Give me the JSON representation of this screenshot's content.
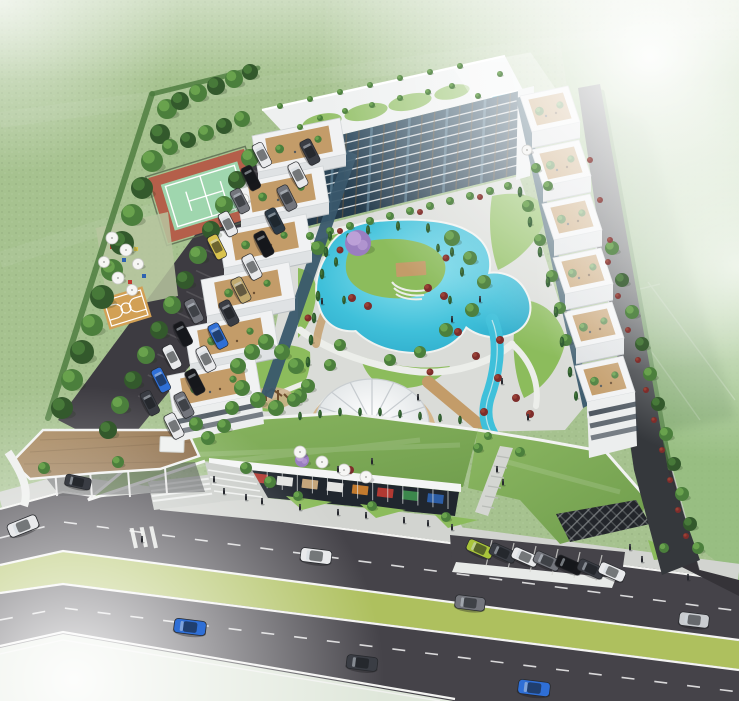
{
  "scene": {
    "type": "aerial-architectural-render",
    "subject": "U-shaped residential complex with landscaped courtyard pool, round pavilion, stepped terrace wings, green-roof retail base, entrance canopy, tennis and basketball courts, parking areas and a boulevard with median"
  },
  "palette": {
    "c_grass_base": "#a6c28f",
    "c_grass_light": "#c6d8b2",
    "c_grass_field": "#93bc7d",
    "c_grass_court": "#8cbc5c",
    "c_grass_roof": "#7fae57",
    "c_median": "#aec05e",
    "c_tree_dark": "#33592c",
    "c_tree_mid": "#4b7f3c",
    "c_tree_light": "#6fa850",
    "c_cypress": "#2d5a2e",
    "c_bush_red": "#7e2d2b",
    "c_bush_red2": "#9c4436",
    "c_tree_purple": "#9a7ec0",
    "c_tree_purple_l": "#c0a4d9",
    "c_water": "#3fc0da",
    "c_water_deep": "#27a3c4",
    "c_water_light": "#90e2ef",
    "c_asphalt": "#454349",
    "c_asphalt_dark": "#353338",
    "c_lot": "#3d3b41",
    "c_white": "#f1f2f3",
    "c_white_dim": "#dfe2e4",
    "c_face_shadow": "#c7ccd0",
    "c_glass": "#223747",
    "c_glass_mid": "#39576b",
    "c_glass_light": "#7fa8bf",
    "c_mullion": "#7c5f3b",
    "c_deck": "#c39c69",
    "c_deck_light": "#d4b183",
    "c_wood_roof": "#9c7b52",
    "c_sidewalk": "#d2d4d0",
    "c_line_white": "#f4f4f2",
    "c_tennis_green": "#9fd6ae",
    "c_tennis_red": "#b45f4a",
    "c_bball": "#d2a055",
    "c_store_dark": "#20262e",
    "c_sign_blue": "#2e62b0",
    "c_sign_red": "#bf3b33",
    "c_sign_orange": "#d2822f",
    "c_sign_green": "#3f8f4f",
    "c_lattice": "#23262b",
    "car_white": "#e9eaec",
    "car_black": "#17181c",
    "car_gray": "#73757c",
    "car_silver": "#c9ccd0",
    "car_blue": "#2f6fd6",
    "car_navy": "#2c3a46",
    "car_lime": "#a9c43b",
    "car_tan": "#c0a96e",
    "car_charcoal": "#3a3d44",
    "car_taxi": "#d9c24c"
  },
  "buildings": {
    "left_wing": {
      "n": 6,
      "ox": 252,
      "oy": 136,
      "sx": -17,
      "sy": 48,
      "bx": 88,
      "by": -18,
      "cx": 6,
      "cy": 36,
      "face": 12
    },
    "right_wing": {
      "n": 6,
      "ox": 520,
      "oy": 96,
      "sx": 11,
      "sy": 54,
      "bx": 48,
      "by": -10,
      "cx": 12,
      "cy": 36,
      "face": 16
    },
    "main_facade": {
      "floors": 9,
      "mullions": 18,
      "tl": [
        296,
        146
      ],
      "tr": [
        523,
        90
      ],
      "bl": [
        292,
        230
      ],
      "br": [
        519,
        174
      ]
    },
    "pavilion": {
      "cx": 372,
      "cy": 424,
      "rx": 57,
      "ry": 45,
      "ribs": 16
    },
    "storefront": {
      "p1": [
        222,
        474
      ],
      "p2": [
        448,
        500
      ],
      "mullions": 15
    }
  },
  "signs": [
    "c_sign_blue",
    "c_sign_red",
    "c_line_white",
    "c_deck_light",
    "c_line_white",
    "c_sign_orange",
    "c_sign_red",
    "c_sign_green",
    "c_sign_blue"
  ],
  "instances": {
    "trees": [
      [
        62,
        408,
        11,
        0
      ],
      [
        72,
        380,
        11,
        1
      ],
      [
        82,
        352,
        12,
        0
      ],
      [
        92,
        325,
        11,
        1
      ],
      [
        102,
        297,
        12,
        0
      ],
      [
        112,
        270,
        11,
        1
      ],
      [
        122,
        243,
        12,
        0
      ],
      [
        132,
        215,
        11,
        1
      ],
      [
        142,
        188,
        11,
        0
      ],
      [
        152,
        161,
        11,
        1
      ],
      [
        160,
        134,
        10,
        0
      ],
      [
        167,
        109,
        10,
        1
      ],
      [
        180,
        101,
        9,
        0
      ],
      [
        198,
        93,
        9,
        1
      ],
      [
        216,
        86,
        9,
        0
      ],
      [
        234,
        79,
        9,
        1
      ],
      [
        250,
        72,
        8,
        0
      ],
      [
        170,
        147,
        8,
        1
      ],
      [
        188,
        140,
        8,
        0
      ],
      [
        206,
        133,
        8,
        1
      ],
      [
        224,
        126,
        8,
        0
      ],
      [
        242,
        119,
        8,
        1
      ],
      [
        108,
        430,
        9,
        0
      ],
      [
        120,
        405,
        9,
        1
      ],
      [
        133,
        380,
        9,
        0
      ],
      [
        146,
        355,
        9,
        1
      ],
      [
        159,
        330,
        9,
        0
      ],
      [
        172,
        305,
        9,
        1
      ],
      [
        185,
        280,
        9,
        0
      ],
      [
        198,
        255,
        9,
        1
      ],
      [
        211,
        230,
        9,
        0
      ],
      [
        224,
        205,
        9,
        1
      ],
      [
        237,
        180,
        9,
        0
      ],
      [
        250,
        158,
        9,
        1
      ],
      [
        612,
        248,
        7,
        1
      ],
      [
        622,
        280,
        7,
        0
      ],
      [
        632,
        312,
        7,
        1
      ],
      [
        642,
        344,
        7,
        0
      ],
      [
        650,
        374,
        7,
        1
      ],
      [
        658,
        404,
        7,
        0
      ],
      [
        666,
        434,
        7,
        1
      ],
      [
        674,
        464,
        7,
        0
      ],
      [
        682,
        494,
        7,
        1
      ],
      [
        690,
        524,
        7,
        0
      ],
      [
        698,
        548,
        6,
        1
      ],
      [
        318,
        248,
        7,
        2
      ],
      [
        452,
        238,
        8,
        2
      ],
      [
        470,
        258,
        7,
        1
      ],
      [
        484,
        282,
        7,
        2
      ],
      [
        472,
        310,
        7,
        1
      ],
      [
        446,
        330,
        7,
        2
      ],
      [
        420,
        352,
        6,
        1
      ],
      [
        390,
        360,
        6,
        2
      ],
      [
        340,
        345,
        6,
        1
      ],
      [
        330,
        365,
        6,
        2
      ],
      [
        300,
        396,
        7,
        1
      ],
      [
        528,
        206,
        6,
        2
      ],
      [
        540,
        240,
        6,
        1
      ],
      [
        552,
        276,
        6,
        2
      ],
      [
        560,
        308,
        6,
        1
      ],
      [
        566,
        340,
        6,
        2
      ],
      [
        536,
        168,
        5,
        1
      ],
      [
        548,
        186,
        5,
        2
      ],
      [
        238,
        366,
        8,
        1
      ],
      [
        252,
        352,
        8,
        2
      ],
      [
        266,
        342,
        8,
        1
      ],
      [
        282,
        352,
        8,
        2
      ],
      [
        296,
        366,
        8,
        1
      ],
      [
        242,
        388,
        8,
        2
      ],
      [
        258,
        400,
        8,
        1
      ],
      [
        276,
        408,
        8,
        2
      ],
      [
        294,
        400,
        7,
        1
      ],
      [
        308,
        386,
        7,
        2
      ],
      [
        232,
        408,
        7,
        1
      ],
      [
        224,
        426,
        7,
        2
      ],
      [
        196,
        424,
        7,
        1
      ],
      [
        208,
        438,
        7,
        2
      ],
      [
        310,
        236,
        4,
        1
      ],
      [
        330,
        231,
        4,
        2
      ],
      [
        350,
        226,
        4,
        1
      ],
      [
        370,
        221,
        4,
        2
      ],
      [
        390,
        216,
        4,
        1
      ],
      [
        410,
        211,
        4,
        2
      ],
      [
        430,
        206,
        4,
        1
      ],
      [
        450,
        201,
        4,
        2
      ],
      [
        470,
        196,
        4,
        1
      ],
      [
        490,
        191,
        4,
        2
      ],
      [
        508,
        186,
        4,
        1
      ],
      [
        320,
        118,
        3,
        1
      ],
      [
        345,
        111,
        3,
        2
      ],
      [
        372,
        105,
        3,
        1
      ],
      [
        400,
        98,
        3,
        2
      ],
      [
        428,
        92,
        3,
        1
      ],
      [
        300,
        127,
        3,
        2
      ],
      [
        452,
        86,
        3,
        1
      ],
      [
        500,
        74,
        3,
        1
      ],
      [
        478,
        96,
        3,
        2
      ],
      [
        280,
        106,
        3,
        2
      ],
      [
        310,
        99,
        3,
        1
      ],
      [
        340,
        92,
        3,
        2
      ],
      [
        370,
        85,
        3,
        1
      ],
      [
        400,
        78,
        3,
        2
      ],
      [
        430,
        72,
        3,
        1
      ],
      [
        460,
        66,
        3,
        2
      ],
      [
        44,
        468,
        6,
        2
      ],
      [
        118,
        462,
        6,
        1
      ],
      [
        246,
        468,
        6,
        2
      ],
      [
        270,
        482,
        6,
        1
      ],
      [
        298,
        496,
        5,
        2
      ],
      [
        372,
        506,
        5,
        1
      ],
      [
        446,
        517,
        5,
        2
      ],
      [
        664,
        548,
        5,
        2
      ],
      [
        478,
        448,
        5,
        1
      ],
      [
        520,
        452,
        5,
        2
      ],
      [
        488,
        436,
        4,
        1
      ]
    ],
    "cypresses": [
      [
        326,
        252,
        1
      ],
      [
        322,
        274,
        1
      ],
      [
        318,
        296,
        1
      ],
      [
        314,
        318,
        1
      ],
      [
        311,
        340,
        1
      ],
      [
        308,
        362,
        1
      ],
      [
        330,
        236,
        0.9
      ],
      [
        452,
        252,
        0.9
      ],
      [
        462,
        272,
        0.9
      ],
      [
        336,
        262,
        0.9
      ],
      [
        344,
        300,
        0.8
      ],
      [
        438,
        248,
        0.8
      ],
      [
        450,
        300,
        0.8
      ],
      [
        520,
        192,
        1
      ],
      [
        530,
        222,
        1
      ],
      [
        540,
        252,
        1
      ],
      [
        548,
        282,
        1
      ],
      [
        556,
        312,
        1
      ],
      [
        562,
        342,
        1
      ],
      [
        570,
        372,
        1
      ],
      [
        576,
        396,
        0.9
      ],
      [
        348,
        238,
        0.9
      ],
      [
        368,
        230,
        0.9
      ],
      [
        398,
        226,
        0.9
      ],
      [
        428,
        228,
        0.9
      ],
      [
        300,
        416,
        0.8
      ],
      [
        320,
        414,
        0.8
      ],
      [
        340,
        412,
        0.8
      ],
      [
        360,
        412,
        0.8
      ],
      [
        380,
        412,
        0.8
      ],
      [
        400,
        414,
        0.8
      ],
      [
        420,
        416,
        0.8
      ],
      [
        440,
        418,
        0.8
      ],
      [
        460,
        420,
        0.8
      ]
    ],
    "bushes_red": [
      [
        352,
        298,
        4
      ],
      [
        368,
        306,
        4
      ],
      [
        428,
        288,
        4
      ],
      [
        444,
        296,
        4
      ],
      [
        458,
        332,
        4
      ],
      [
        476,
        356,
        4
      ],
      [
        498,
        378,
        4
      ],
      [
        516,
        398,
        4
      ],
      [
        308,
        318,
        3.5
      ],
      [
        500,
        340,
        4
      ],
      [
        530,
        414,
        4
      ],
      [
        350,
        470,
        4
      ],
      [
        302,
        452,
        3.5
      ],
      [
        430,
        372,
        3.5
      ],
      [
        484,
        412,
        4
      ],
      [
        340,
        250,
        3.5
      ],
      [
        446,
        258,
        3.5
      ],
      [
        608,
        262,
        3
      ],
      [
        618,
        296,
        3
      ],
      [
        628,
        330,
        3
      ],
      [
        638,
        360,
        3
      ],
      [
        646,
        390,
        3
      ],
      [
        654,
        420,
        3
      ],
      [
        662,
        450,
        3
      ],
      [
        670,
        480,
        3
      ],
      [
        678,
        510,
        3
      ],
      [
        686,
        536,
        3
      ],
      [
        340,
        231,
        3
      ],
      [
        420,
        212,
        3
      ],
      [
        480,
        197,
        3
      ],
      [
        590,
        160,
        3
      ],
      [
        600,
        200,
        3
      ],
      [
        610,
        240,
        3
      ]
    ],
    "purple_trees": [
      [
        358,
        243,
        13
      ],
      [
        302,
        460,
        7
      ]
    ],
    "umbrellas": [
      [
        112,
        238,
        6
      ],
      [
        126,
        250,
        6
      ],
      [
        104,
        262,
        5.5
      ],
      [
        138,
        264,
        5.5
      ],
      [
        118,
        278,
        6
      ],
      [
        132,
        290,
        5.5
      ],
      [
        300,
        452,
        6
      ],
      [
        322,
        462,
        6
      ],
      [
        344,
        470,
        6
      ],
      [
        366,
        477,
        6
      ],
      [
        244,
        199,
        5
      ],
      [
        527,
        150,
        5
      ]
    ],
    "people": [
      [
        246,
        498
      ],
      [
        262,
        502
      ],
      [
        300,
        508
      ],
      [
        338,
        513
      ],
      [
        366,
        516
      ],
      [
        404,
        521
      ],
      [
        428,
        524
      ],
      [
        452,
        528
      ],
      [
        497,
        470
      ],
      [
        503,
        483
      ],
      [
        322,
        302
      ],
      [
        452,
        320
      ],
      [
        502,
        382
      ],
      [
        528,
        418
      ],
      [
        372,
        462
      ],
      [
        338,
        470
      ],
      [
        214,
        480
      ],
      [
        224,
        492
      ],
      [
        142,
        540
      ],
      [
        630,
        548
      ],
      [
        642,
        560
      ],
      [
        688,
        578
      ],
      [
        480,
        300
      ],
      [
        418,
        398
      ]
    ],
    "cars": [
      [
        23,
        526,
        -22,
        "car_white",
        1.55
      ],
      [
        316,
        556,
        7,
        "car_white",
        1.55
      ],
      [
        470,
        603,
        7,
        "car_gray",
        1.5
      ],
      [
        694,
        620,
        7,
        "car_silver",
        1.5
      ],
      [
        190,
        627,
        7,
        "car_blue",
        1.6
      ],
      [
        362,
        663,
        7,
        "car_charcoal",
        1.55
      ],
      [
        534,
        688,
        7,
        "car_blue",
        1.6
      ],
      [
        480,
        549,
        24,
        "car_lime",
        1.35
      ],
      [
        503,
        553,
        24,
        "car_charcoal",
        1.35
      ],
      [
        525,
        557,
        24,
        "car_white",
        1.35
      ],
      [
        547,
        561,
        24,
        "car_gray",
        1.35
      ],
      [
        569,
        565,
        24,
        "car_black",
        1.35
      ],
      [
        591,
        569,
        24,
        "car_charcoal",
        1.35
      ],
      [
        612,
        572,
        24,
        "car_white",
        1.35
      ],
      [
        310,
        152,
        63,
        "car_charcoal",
        1.3
      ],
      [
        298,
        175,
        63,
        "car_white",
        1.3
      ],
      [
        287,
        198,
        63,
        "car_gray",
        1.3
      ],
      [
        275,
        221,
        63,
        "car_navy",
        1.3
      ],
      [
        264,
        244,
        63,
        "car_black",
        1.3
      ],
      [
        252,
        267,
        63,
        "car_white",
        1.3
      ],
      [
        241,
        290,
        63,
        "car_tan",
        1.3
      ],
      [
        229,
        313,
        63,
        "car_charcoal",
        1.3
      ],
      [
        218,
        336,
        63,
        "car_blue",
        1.3
      ],
      [
        206,
        359,
        63,
        "car_white",
        1.3
      ],
      [
        195,
        382,
        63,
        "car_black",
        1.3
      ],
      [
        184,
        405,
        63,
        "car_gray",
        1.3
      ],
      [
        174,
        426,
        63,
        "car_white",
        1.3
      ],
      [
        262,
        155,
        63,
        "car_white",
        1.25
      ],
      [
        251,
        178,
        63,
        "car_black",
        1.25
      ],
      [
        240,
        201,
        63,
        "car_gray",
        1.25
      ],
      [
        228,
        224,
        63,
        "car_white",
        1.25
      ],
      [
        217,
        247,
        63,
        "car_taxi",
        1.25
      ],
      [
        150,
        403,
        63,
        "car_charcoal",
        1.25
      ],
      [
        161,
        380,
        63,
        "car_blue",
        1.25
      ],
      [
        172,
        357,
        63,
        "car_white",
        1.25
      ],
      [
        183,
        334,
        63,
        "car_black",
        1.25
      ],
      [
        194,
        311,
        63,
        "car_gray",
        1.25
      ],
      [
        78,
        482,
        12,
        "car_charcoal",
        1.3
      ]
    ]
  }
}
